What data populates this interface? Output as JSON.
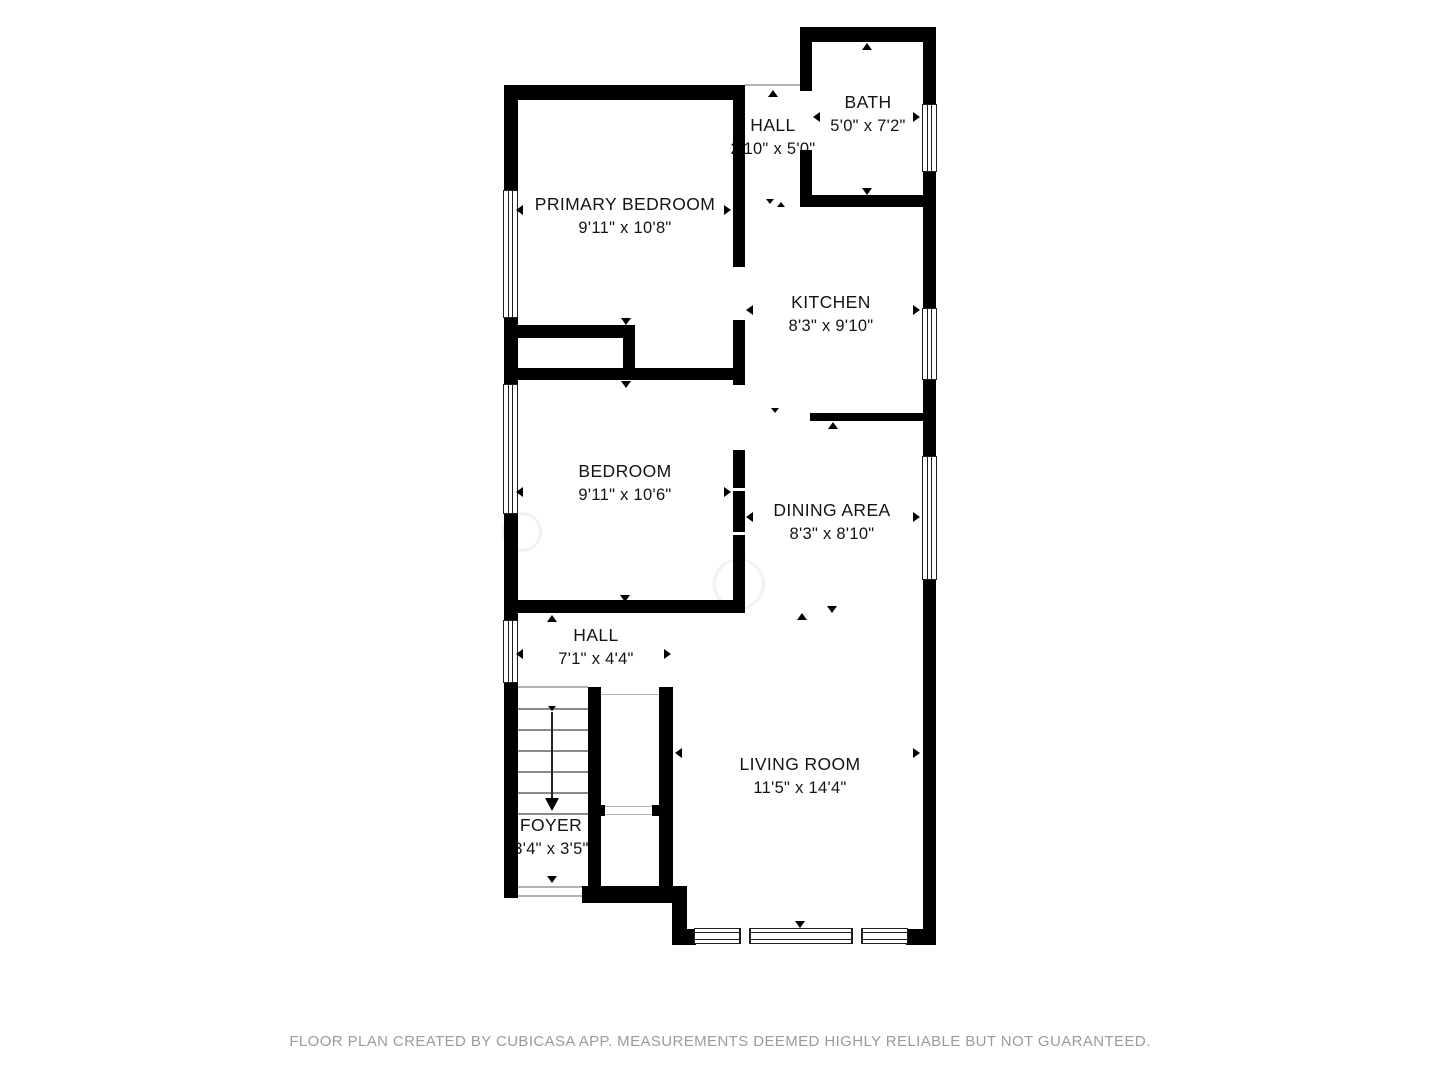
{
  "rooms": [
    {
      "name": "PRIMARY BEDROOM",
      "dims": "9'11\" x 10'8\""
    },
    {
      "name": "HALL",
      "dims": "2'10\" x 5'0\""
    },
    {
      "name": "BATH",
      "dims": "5'0\" x 7'2\""
    },
    {
      "name": "KITCHEN",
      "dims": "8'3\" x 9'10\""
    },
    {
      "name": "BEDROOM",
      "dims": "9'11\" x 10'6\""
    },
    {
      "name": "DINING AREA",
      "dims": "8'3\" x 8'10\""
    },
    {
      "name": "HALL",
      "dims": "7'1\" x 4'4\""
    },
    {
      "name": "LIVING ROOM",
      "dims": "11'5\" x 14'4\""
    },
    {
      "name": "FOYER",
      "dims": "3'4\" x 3'5\""
    }
  ],
  "footer": "FLOOR PLAN CREATED BY CUBICASA APP. MEASUREMENTS DEEMED HIGHLY RELIABLE BUT NOT GUARANTEED.",
  "colors": {
    "wall": "#000000",
    "label_text": "#141414",
    "footer_text": "#9b9b9b"
  }
}
